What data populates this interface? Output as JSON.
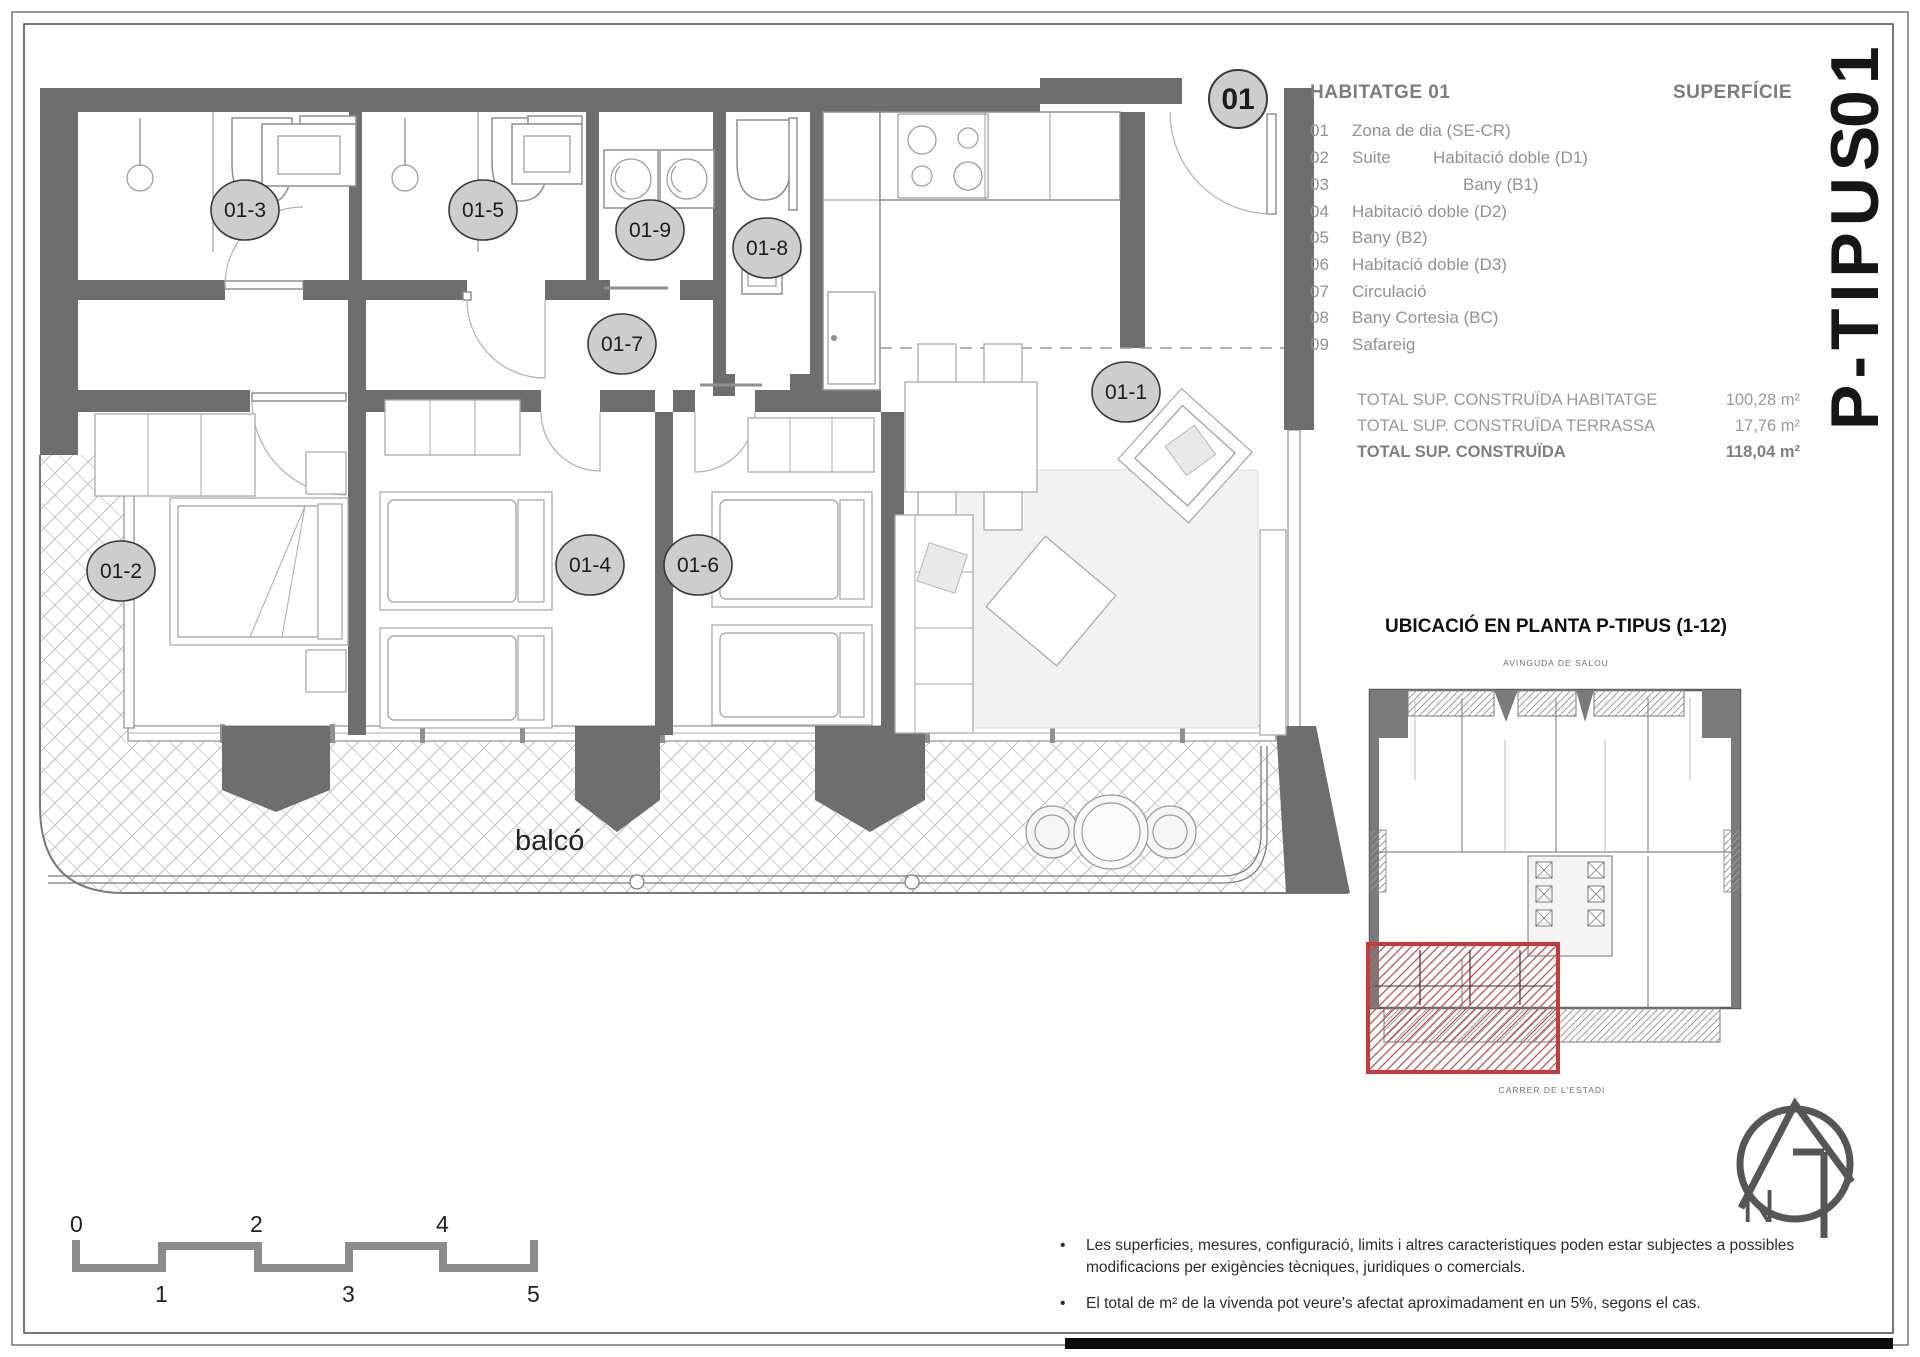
{
  "sheet": {
    "title_part1": "P-TIPUS",
    "title_part2": "01"
  },
  "legend": {
    "header": "HABITATGE 01",
    "superficie_header": "SUPERFÍCIE",
    "items": [
      {
        "num": "01",
        "name": "Zona de dia (SE-CR)",
        "name2": ""
      },
      {
        "num": "02",
        "name": "Suite",
        "name2": "Habitació doble (D1)"
      },
      {
        "num": "03",
        "name": "",
        "name2": "Bany (B1)"
      },
      {
        "num": "04",
        "name": "Habitació doble (D2)",
        "name2": ""
      },
      {
        "num": "05",
        "name": "Bany (B2)",
        "name2": ""
      },
      {
        "num": "06",
        "name": "Habitació doble (D3)",
        "name2": ""
      },
      {
        "num": "07",
        "name": "Circulació",
        "name2": ""
      },
      {
        "num": "08",
        "name": "Bany Cortesia (BC)",
        "name2": ""
      },
      {
        "num": "09",
        "name": "Safareig",
        "name2": ""
      }
    ],
    "totals": [
      {
        "label": "TOTAL SUP. CONSTRUÏDA HABITATGE",
        "value": "100,28 m²"
      },
      {
        "label": "TOTAL SUP. CONSTRUÏDA TERRASSA",
        "value": "17,76 m²"
      },
      {
        "label": "TOTAL SUP. CONSTRUÏDA",
        "value": "118,04 m²"
      }
    ]
  },
  "plan": {
    "room_labels": [
      "01",
      "01-1",
      "01-2",
      "01-3",
      "01-4",
      "01-5",
      "01-6",
      "01-7",
      "01-8",
      "01-9"
    ],
    "balcony_label": "balcó"
  },
  "location": {
    "title": "UBICACIÓ EN PLANTA P-TIPUS (1-12)",
    "street_top": "AVINGUDA DE SALOU",
    "street_bottom": "CARRER DE L'ESTADI"
  },
  "north": {
    "label": "N"
  },
  "scalebar": {
    "top": [
      "0",
      "2",
      "4"
    ],
    "bottom": [
      "1",
      "3",
      "5"
    ]
  },
  "notes": {
    "bullet": "•",
    "n1_line1": "Les superficies, mesures, configuració, limits i altres caracteristiques poden estar subjectes a possibles",
    "n1_line2": "modificacions per exigències tècniques, juridiques o comercials.",
    "n2": "El total de m² de la vivenda pot veure's afectat aproximadament en un 5%, segons el cas."
  },
  "colors": {
    "wall": "#6e6e6e",
    "highlight_red": "#c43b3b",
    "label_circle": "#cdcdcd",
    "legend_gray": "#929292"
  }
}
